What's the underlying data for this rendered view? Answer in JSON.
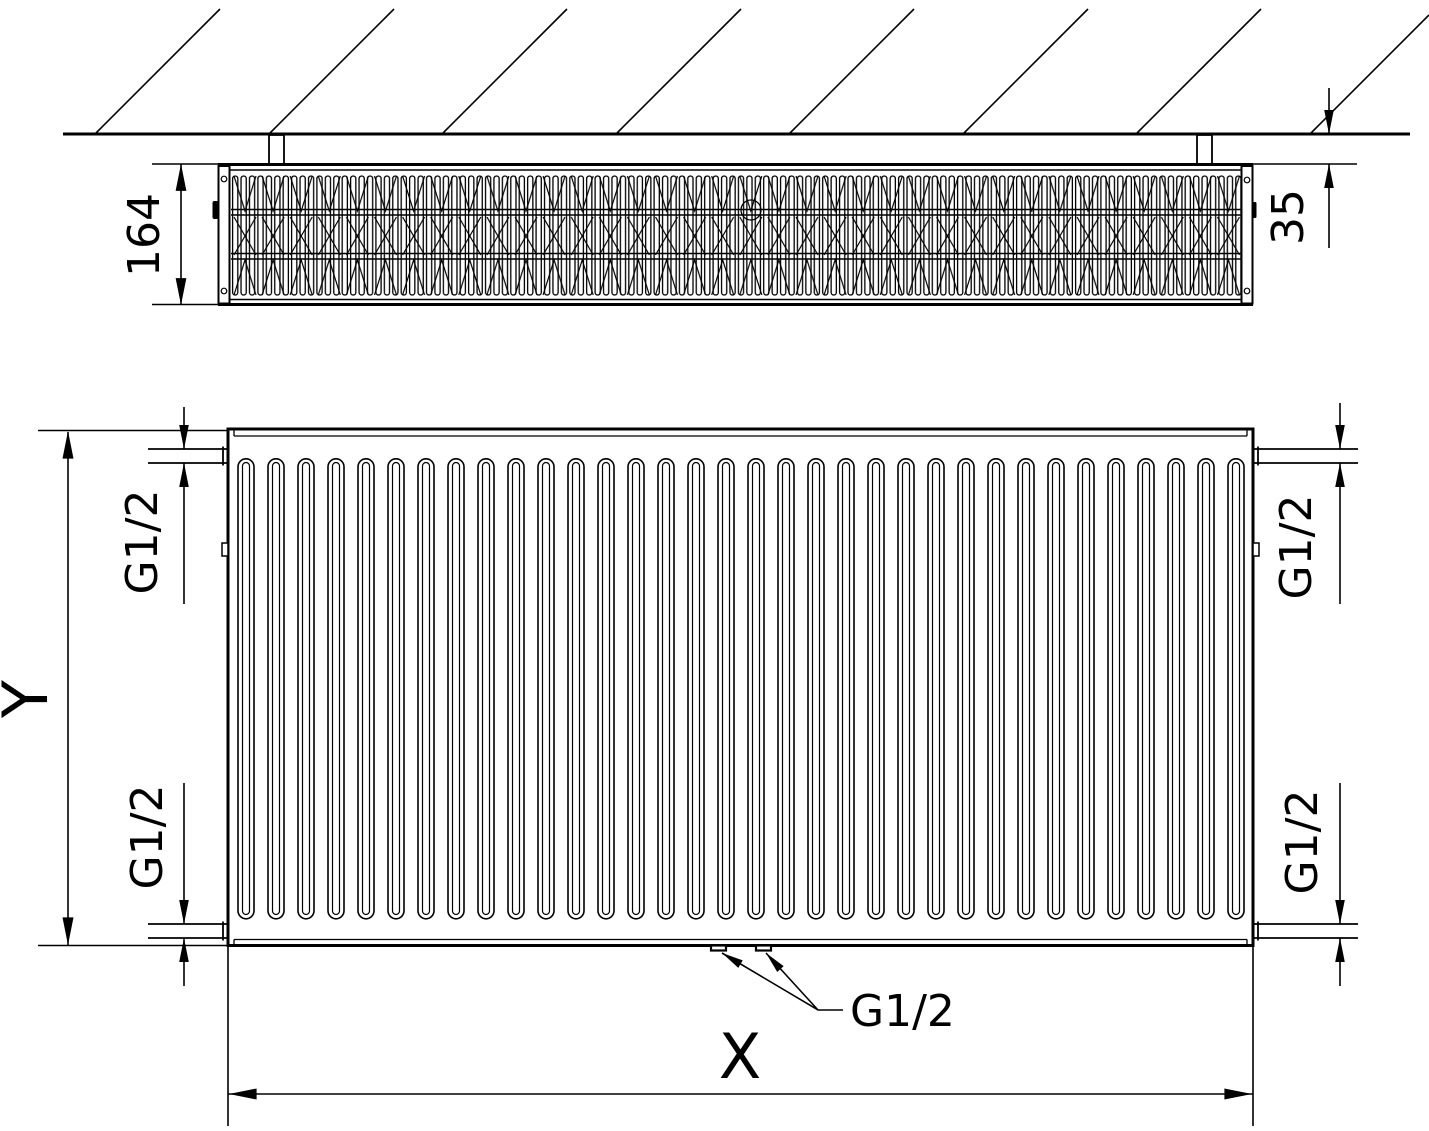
{
  "colors": {
    "line_color": "#000000",
    "background_color": "#ffffff"
  },
  "top_view": {
    "depth_label": "164",
    "wall_gap_label": "35"
  },
  "front_view": {
    "height_label": "Y",
    "width_label": "X",
    "connections": {
      "top_left": "G1/2",
      "top_right": "G1/2",
      "bottom_left": "G1/2",
      "bottom_right": "G1/2",
      "bottom_center": "G1/2"
    }
  }
}
